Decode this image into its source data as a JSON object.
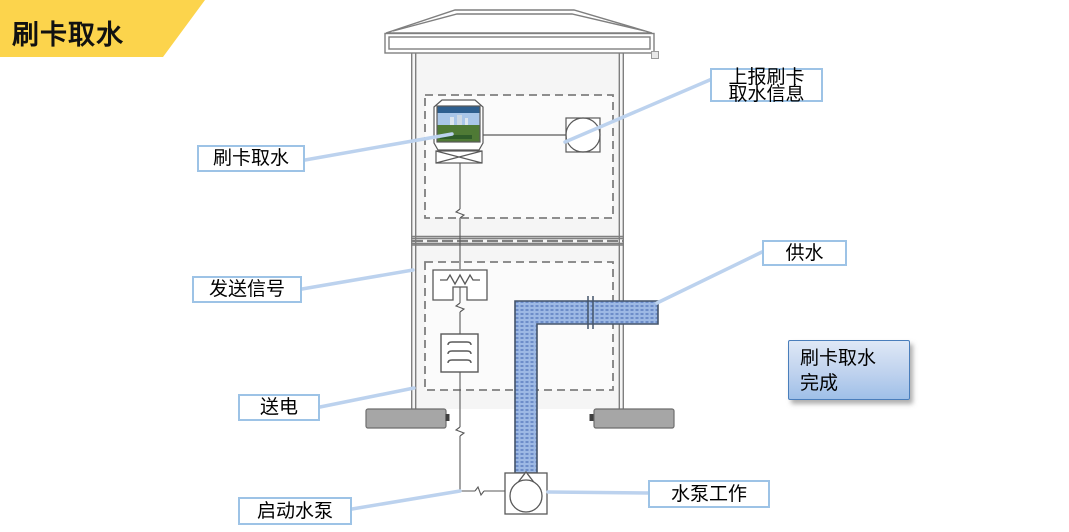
{
  "banner": {
    "title": "刷卡取水"
  },
  "callouts": {
    "swipe_card": "刷卡取水",
    "report_line1": "上报刷卡",
    "report_line2": "取水信息",
    "send_signal": "发送信号",
    "power_on": "送电",
    "start_pump": "启动水泵",
    "pump_working": "水泵工作",
    "water_supply": "供水"
  },
  "completion": {
    "line1": "刷卡取水",
    "line2": "完成"
  },
  "icons": {
    "card_reader": "card-reader-terminal-icon",
    "meter": "round-meter-icon",
    "relay": "relay-resistor-icon",
    "terminal_block": "terminal-block-icon",
    "pump": "water-pump-icon",
    "pipe": "water-pipe",
    "roof": "well-house-roof",
    "foundation": "concrete-footing"
  },
  "colors": {
    "accent-yellow": "#FCD44C",
    "callout-line": "#bcd2ee",
    "label-border": "#9dc3e6",
    "pipe-fill": "#9db9e4",
    "pipe-dot": "#6d8dc9",
    "pipe-border": "#44546a",
    "complete-grad-top": "#dfe8f6",
    "complete-grad-bottom": "#9fc0e8",
    "complete-border": "#4a7ebb",
    "structure-stroke": "#7f7f7f",
    "device-stroke": "#595959",
    "footing-fill": "#a6a6a6"
  }
}
